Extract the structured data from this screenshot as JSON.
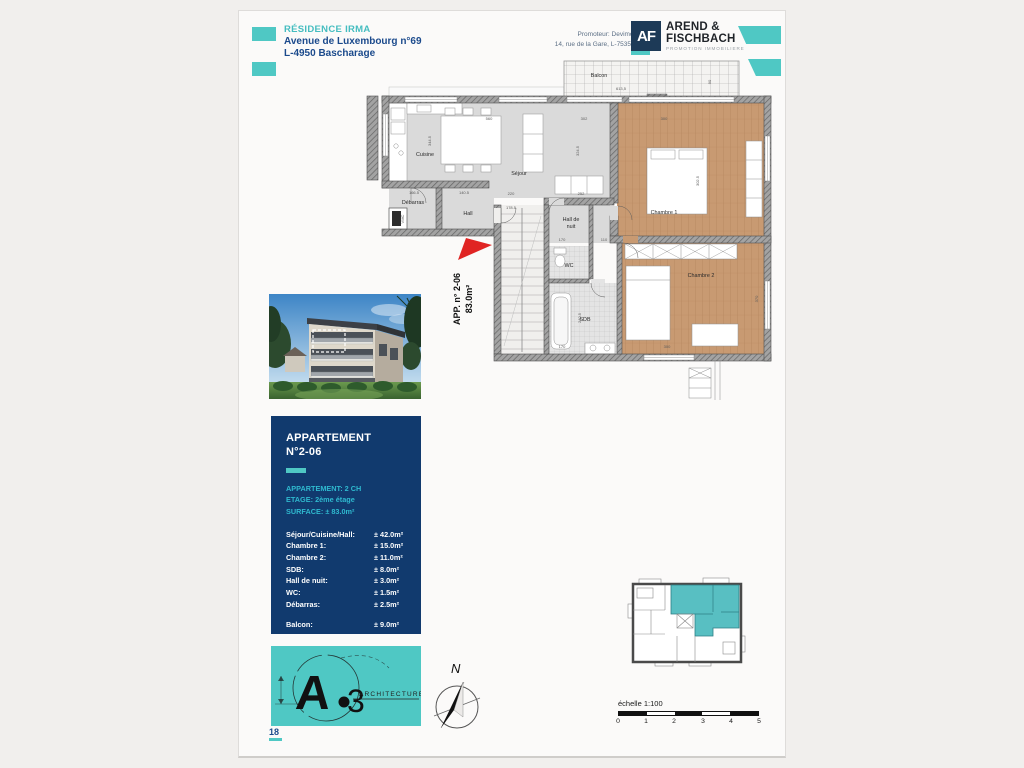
{
  "header": {
    "project": "RÉSIDENCE IRMA",
    "address1": "Avenue de Luxembourg n°69",
    "address2": "L-4950 Bascharage",
    "promoter1": "Promoteur: Devimolux s.à r.l.",
    "promoter2": "14, rue de la Gare, L-7535 MERSCH",
    "monogram": "AF",
    "brand1": "AREND &",
    "brand2": "FISCHBACH",
    "brand_sub": "PROMOTION IMMOBILIERE"
  },
  "plan": {
    "apartment_label": "APP. n° 2-06",
    "apartment_area": "83.0m²",
    "rooms": {
      "balcon": "Balcon",
      "cuisine": "Cuisine",
      "sejour": "Séjour",
      "chambre1": "Chambre 1",
      "chambre2": "Chambre 2",
      "debarras": "Débarras",
      "hall": "Hall",
      "hdn1": "Hall de",
      "hdn2": "nuit",
      "wc": "WC",
      "sdb": "SDB",
      "vmc": "VMC"
    },
    "dims": [
      "613,5",
      "90",
      "560",
      "302",
      "300",
      "344.5",
      "324.5",
      "302.5",
      "220",
      "252",
      "166.5",
      "140.5",
      "178.5",
      "170",
      "110",
      "240.5",
      "170",
      "300",
      "370"
    ]
  },
  "info_box": {
    "title1": "APPARTEMENT",
    "title2": "N°2-06",
    "meta": [
      {
        "label": "APPARTEMENT:",
        "value": "2 CH"
      },
      {
        "label": "ETAGE:",
        "value": "2ème étage"
      },
      {
        "label": "SURFACE:",
        "value": "± 83.0m²"
      }
    ],
    "rooms": [
      {
        "label": "Séjour/Cuisine/Hall:",
        "value": "± 42.0m²"
      },
      {
        "label": "Chambre 1:",
        "value": "± 15.0m²"
      },
      {
        "label": "Chambre 2:",
        "value": "± 11.0m²"
      },
      {
        "label": "SDB:",
        "value": "± 8.0m²"
      },
      {
        "label": "Hall de nuit:",
        "value": "± 3.0m²"
      },
      {
        "label": "WC:",
        "value": "± 1.5m²"
      },
      {
        "label": "Débarras:",
        "value": "± 2.5m²"
      }
    ],
    "balcony": {
      "label": "Balcon:",
      "value": "± 9.0m²"
    }
  },
  "architect": {
    "letter": "A",
    "digit": "3",
    "label": "ARCHITECTURE"
  },
  "compass": {
    "north": "N"
  },
  "scale": {
    "label": "échelle 1:100",
    "ticks": [
      "0",
      "1",
      "2",
      "3",
      "4",
      "5"
    ]
  },
  "page": {
    "number": "18"
  },
  "colors": {
    "teal": "#4fc8c4",
    "navy_box": "#113a6e",
    "navy_text": "#1b4a8c",
    "teal_text": "#2fb9cf",
    "brand_square": "#1d3a57",
    "wood": "#c89a72",
    "marker_red": "#e02423"
  }
}
